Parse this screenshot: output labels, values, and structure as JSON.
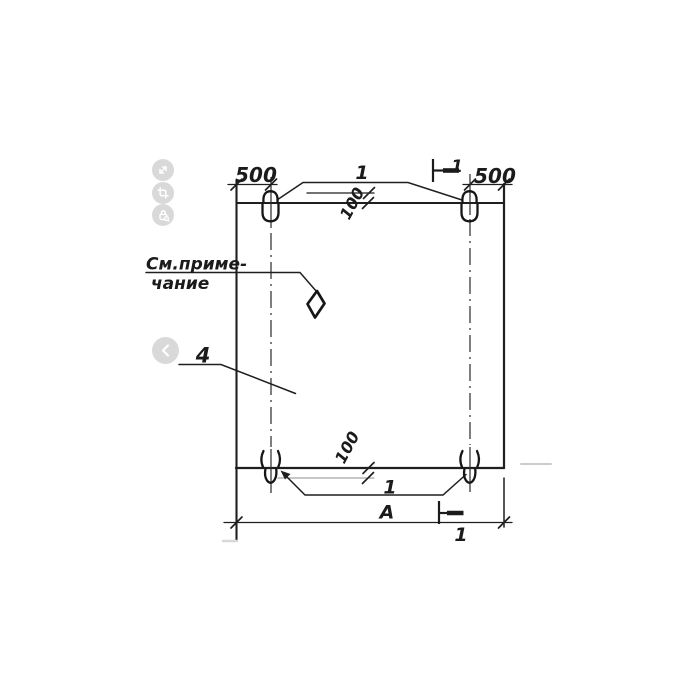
{
  "viewer": {
    "toolbar_icons": [
      {
        "name": "expand"
      },
      {
        "name": "crop"
      },
      {
        "name": "lock"
      }
    ],
    "nav": {
      "prev": "chevron-left"
    }
  },
  "drawing": {
    "kind": "precast panel elevation with lifting loops, section 1-1",
    "note": {
      "line1": "См.приме-",
      "line2": "чание"
    },
    "dimensions": {
      "left_loop_offset": "500",
      "right_loop_offset": "500",
      "top_loop_height": "100",
      "bottom_loop_height": "100",
      "overall_width": "А"
    },
    "callouts": {
      "loops_top": "1",
      "loops_bottom": "1",
      "panel": "4"
    },
    "section_marks": {
      "top": "1",
      "bottom": "1"
    },
    "colors": {
      "line": "#1f1f1f",
      "faint_line": "#8d8d8d",
      "scan_artifact": "#cccccc",
      "icon_background": "#d9d9d9",
      "icon_glyph": "#ffffff",
      "background": "#ffffff"
    }
  }
}
